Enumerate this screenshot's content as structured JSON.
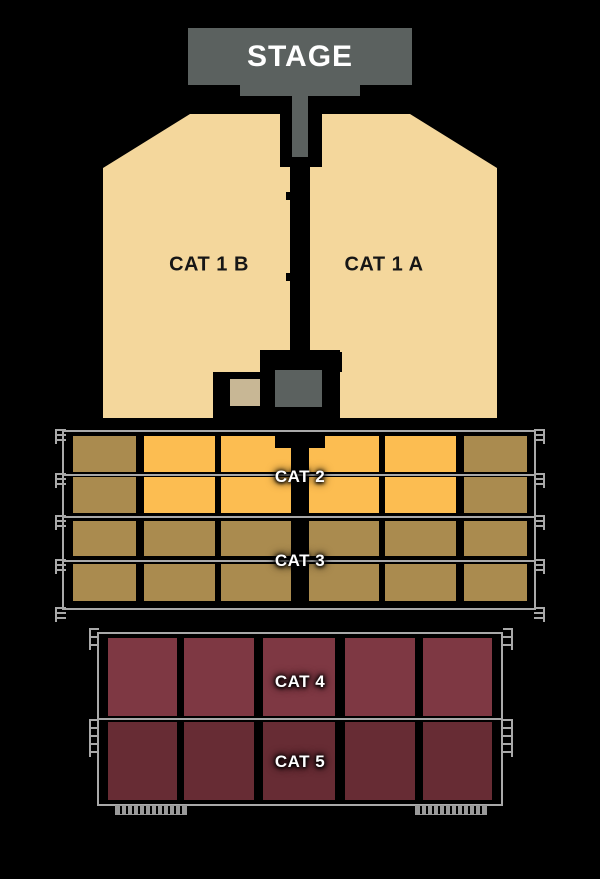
{
  "stage": {
    "label": "STAGE"
  },
  "sections": {
    "cat1b": {
      "label": "CAT 1 B"
    },
    "cat1a": {
      "label": "CAT 1 A"
    },
    "cat2": {
      "label": "CAT 2"
    },
    "cat3": {
      "label": "CAT 3"
    },
    "cat4": {
      "label": "CAT 4"
    },
    "cat5": {
      "label": "CAT 5"
    }
  },
  "colors": {
    "background": "#000000",
    "stage_gray": "#5b615f",
    "cat1_beige": "#f4d79c",
    "orange": "#fcbd51",
    "khaki": "#aa8b4f",
    "cat4_maroon": "#7e3843",
    "cat5_maroon": "#672c34",
    "tan_box": "#c8b795",
    "rail_gray": "#a9a9a9",
    "label_white": "#ffffff",
    "label_black": "#161616"
  },
  "middle_grid": {
    "rows": [
      {
        "name": "cat2-upper-row",
        "cols": [
          "khaki",
          "orange",
          "orange",
          "orange",
          "orange",
          "khaki"
        ],
        "notched": true
      },
      {
        "name": "cat2-lower-row",
        "cols": [
          "khaki",
          "orange",
          "orange",
          "orange",
          "orange",
          "khaki"
        ],
        "notched": false
      },
      {
        "name": "cat3-upper-row",
        "cols": [
          "khaki",
          "khaki",
          "khaki",
          "khaki",
          "khaki",
          "khaki"
        ],
        "notched": false
      },
      {
        "name": "cat3-lower-row",
        "cols": [
          "khaki",
          "khaki",
          "khaki",
          "khaki",
          "khaki",
          "khaki"
        ],
        "notched": false
      }
    ]
  },
  "bottom_grid": {
    "rows": [
      {
        "name": "cat4-row",
        "color": "cat4_maroon",
        "blocks": 5
      },
      {
        "name": "cat5-row",
        "color": "cat5_maroon",
        "blocks": 5
      }
    ]
  }
}
